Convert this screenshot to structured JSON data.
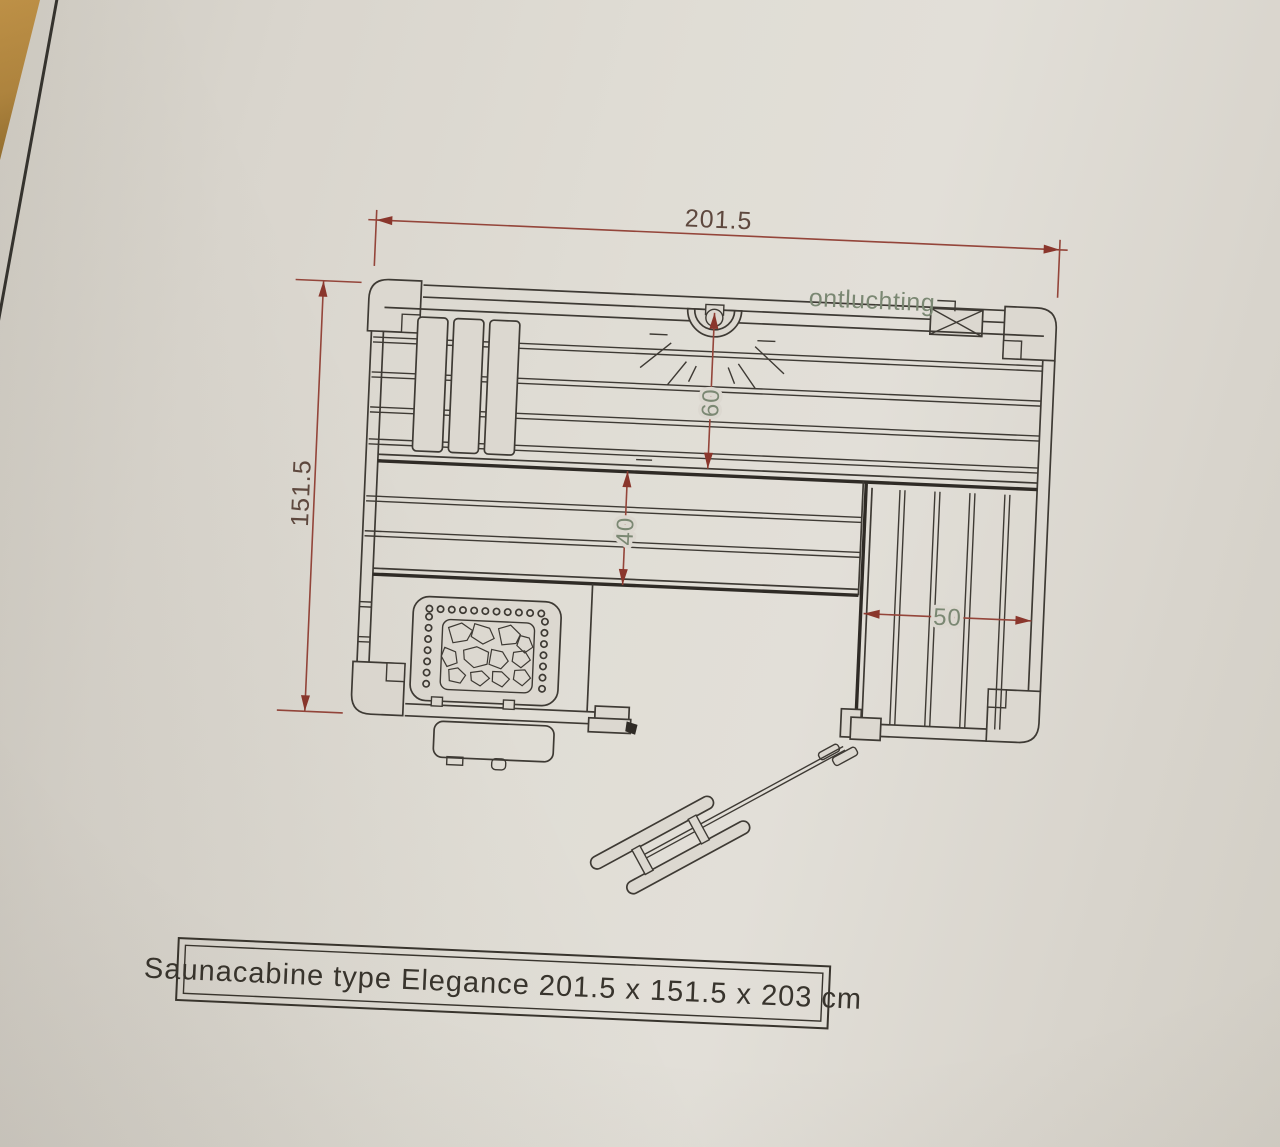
{
  "title_block": {
    "text": "Saunacabine type Elegance 201.5 x 151.5 x 203 cm"
  },
  "annotations": {
    "vent_label": "ontluchting"
  },
  "dimensions": {
    "overall_width_cm": "201.5",
    "overall_depth_cm": "151.5",
    "light_clearance_cm": "60",
    "bench_depth_cm": "40",
    "side_bench_width_cm": "50"
  },
  "colors": {
    "paper": "#dcd8d0",
    "ink": "#3e3a34",
    "dimension_red": "#94453a",
    "dimension_text": "#5e483e",
    "annotation_green": "#7b8873",
    "table_wood": "#b0853e"
  }
}
